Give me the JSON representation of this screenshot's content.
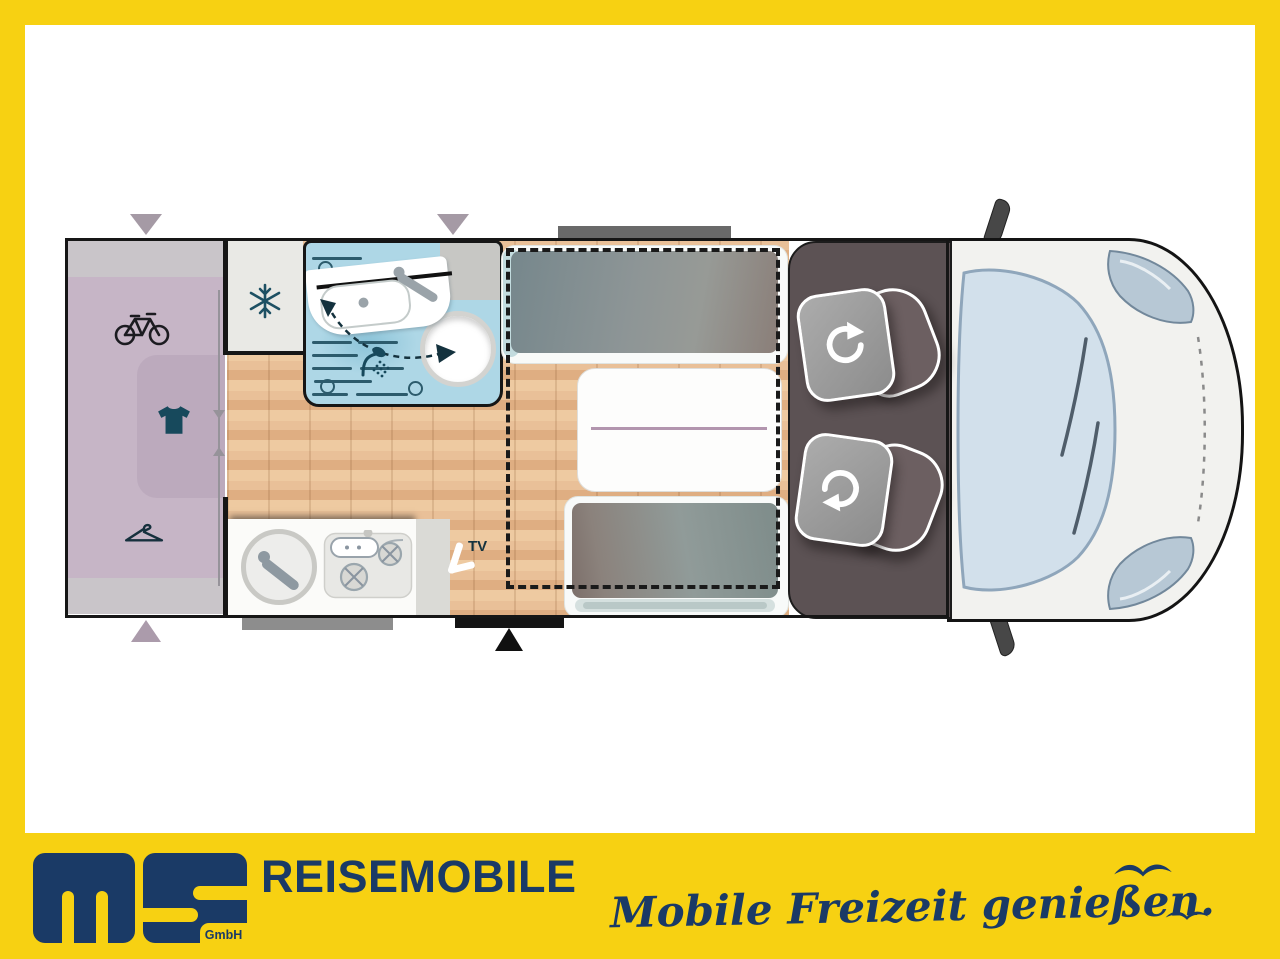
{
  "window": {
    "width": 1280,
    "height": 959
  },
  "colors": {
    "frame_yellow": "#F7D112",
    "brand_navy": "#1A3A66",
    "wood_floor": "#E2B38A",
    "bathroom_blue": "#AED7E6",
    "garage_purple": "#C6B5C6",
    "garage_gray": "#C9C5C9",
    "cab_floor": "#5C5254",
    "cushion_gray": "#8D9596",
    "icon_teal": "#17495C"
  },
  "floorplan": {
    "tv_label": "TV",
    "areas": [
      "rear-garage",
      "wardrobe",
      "fridge",
      "bathroom-with-swivel-wall",
      "kitchen",
      "dinette-with-table",
      "drop-down-bed-outline",
      "cab-with-swivel-seats",
      "vehicle-front"
    ],
    "icons": [
      "bicycle-icon",
      "tshirt-icon",
      "hanger-icon",
      "snowflake-icon",
      "shower-icon",
      "toilet-icon",
      "washbasin-icon",
      "kitchen-sink-icon",
      "stove-icon",
      "tv-icon",
      "swivel-seat-icon",
      "swivel-seat-icon",
      "window-marker",
      "entry-door-marker"
    ]
  },
  "footer": {
    "logo_monogram": "MS",
    "logo_sub": "GmbH",
    "brand": "REISEMOBILE",
    "slogan": "Mobile Freizeit genießen.",
    "icons": [
      "bird-icon",
      "bird-icon"
    ]
  }
}
